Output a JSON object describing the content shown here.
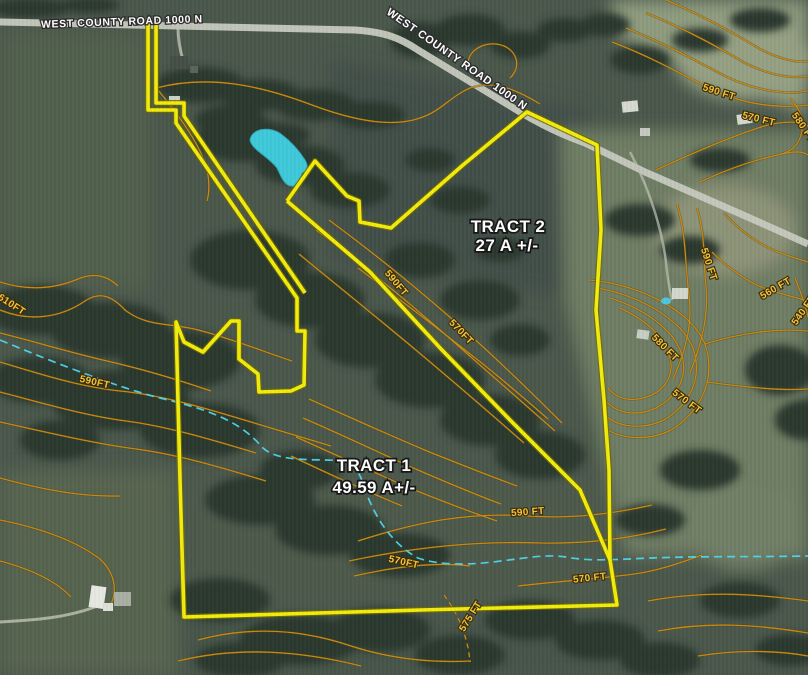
{
  "road_labels": {
    "top": "WEST COUNTY ROAD 1000 N",
    "diagonal": "WEST COUNTY ROAD 1000 N"
  },
  "tract_labels": [
    {
      "name": "TRACT 2",
      "acres": "27 A +/-"
    },
    {
      "name": "TRACT 1",
      "acres": "49.59 A+/-"
    }
  ],
  "contour_labels": [
    {
      "text": "590 FT"
    },
    {
      "text": "570 FT"
    },
    {
      "text": "580 FT"
    },
    {
      "text": "590 FT"
    },
    {
      "text": "560 FT"
    },
    {
      "text": "540 FT"
    },
    {
      "text": "580 FT"
    },
    {
      "text": "570 FT"
    },
    {
      "text": "610FT"
    },
    {
      "text": "590FT"
    },
    {
      "text": "590FT"
    },
    {
      "text": "570FT"
    },
    {
      "text": "590 FT"
    },
    {
      "text": "570FT"
    },
    {
      "text": "570 FT"
    },
    {
      "text": "575 FT"
    }
  ],
  "colors": {
    "boundary_yellow": "#f3ec0e",
    "contour_orange": "#c68a16",
    "contour_label_gold": "#f2c43d",
    "stream_cyan": "#4fd6ee",
    "pond_cyan": "#3ec9da",
    "road_gray": "#c7cabf",
    "label_white": "#ffffff"
  }
}
